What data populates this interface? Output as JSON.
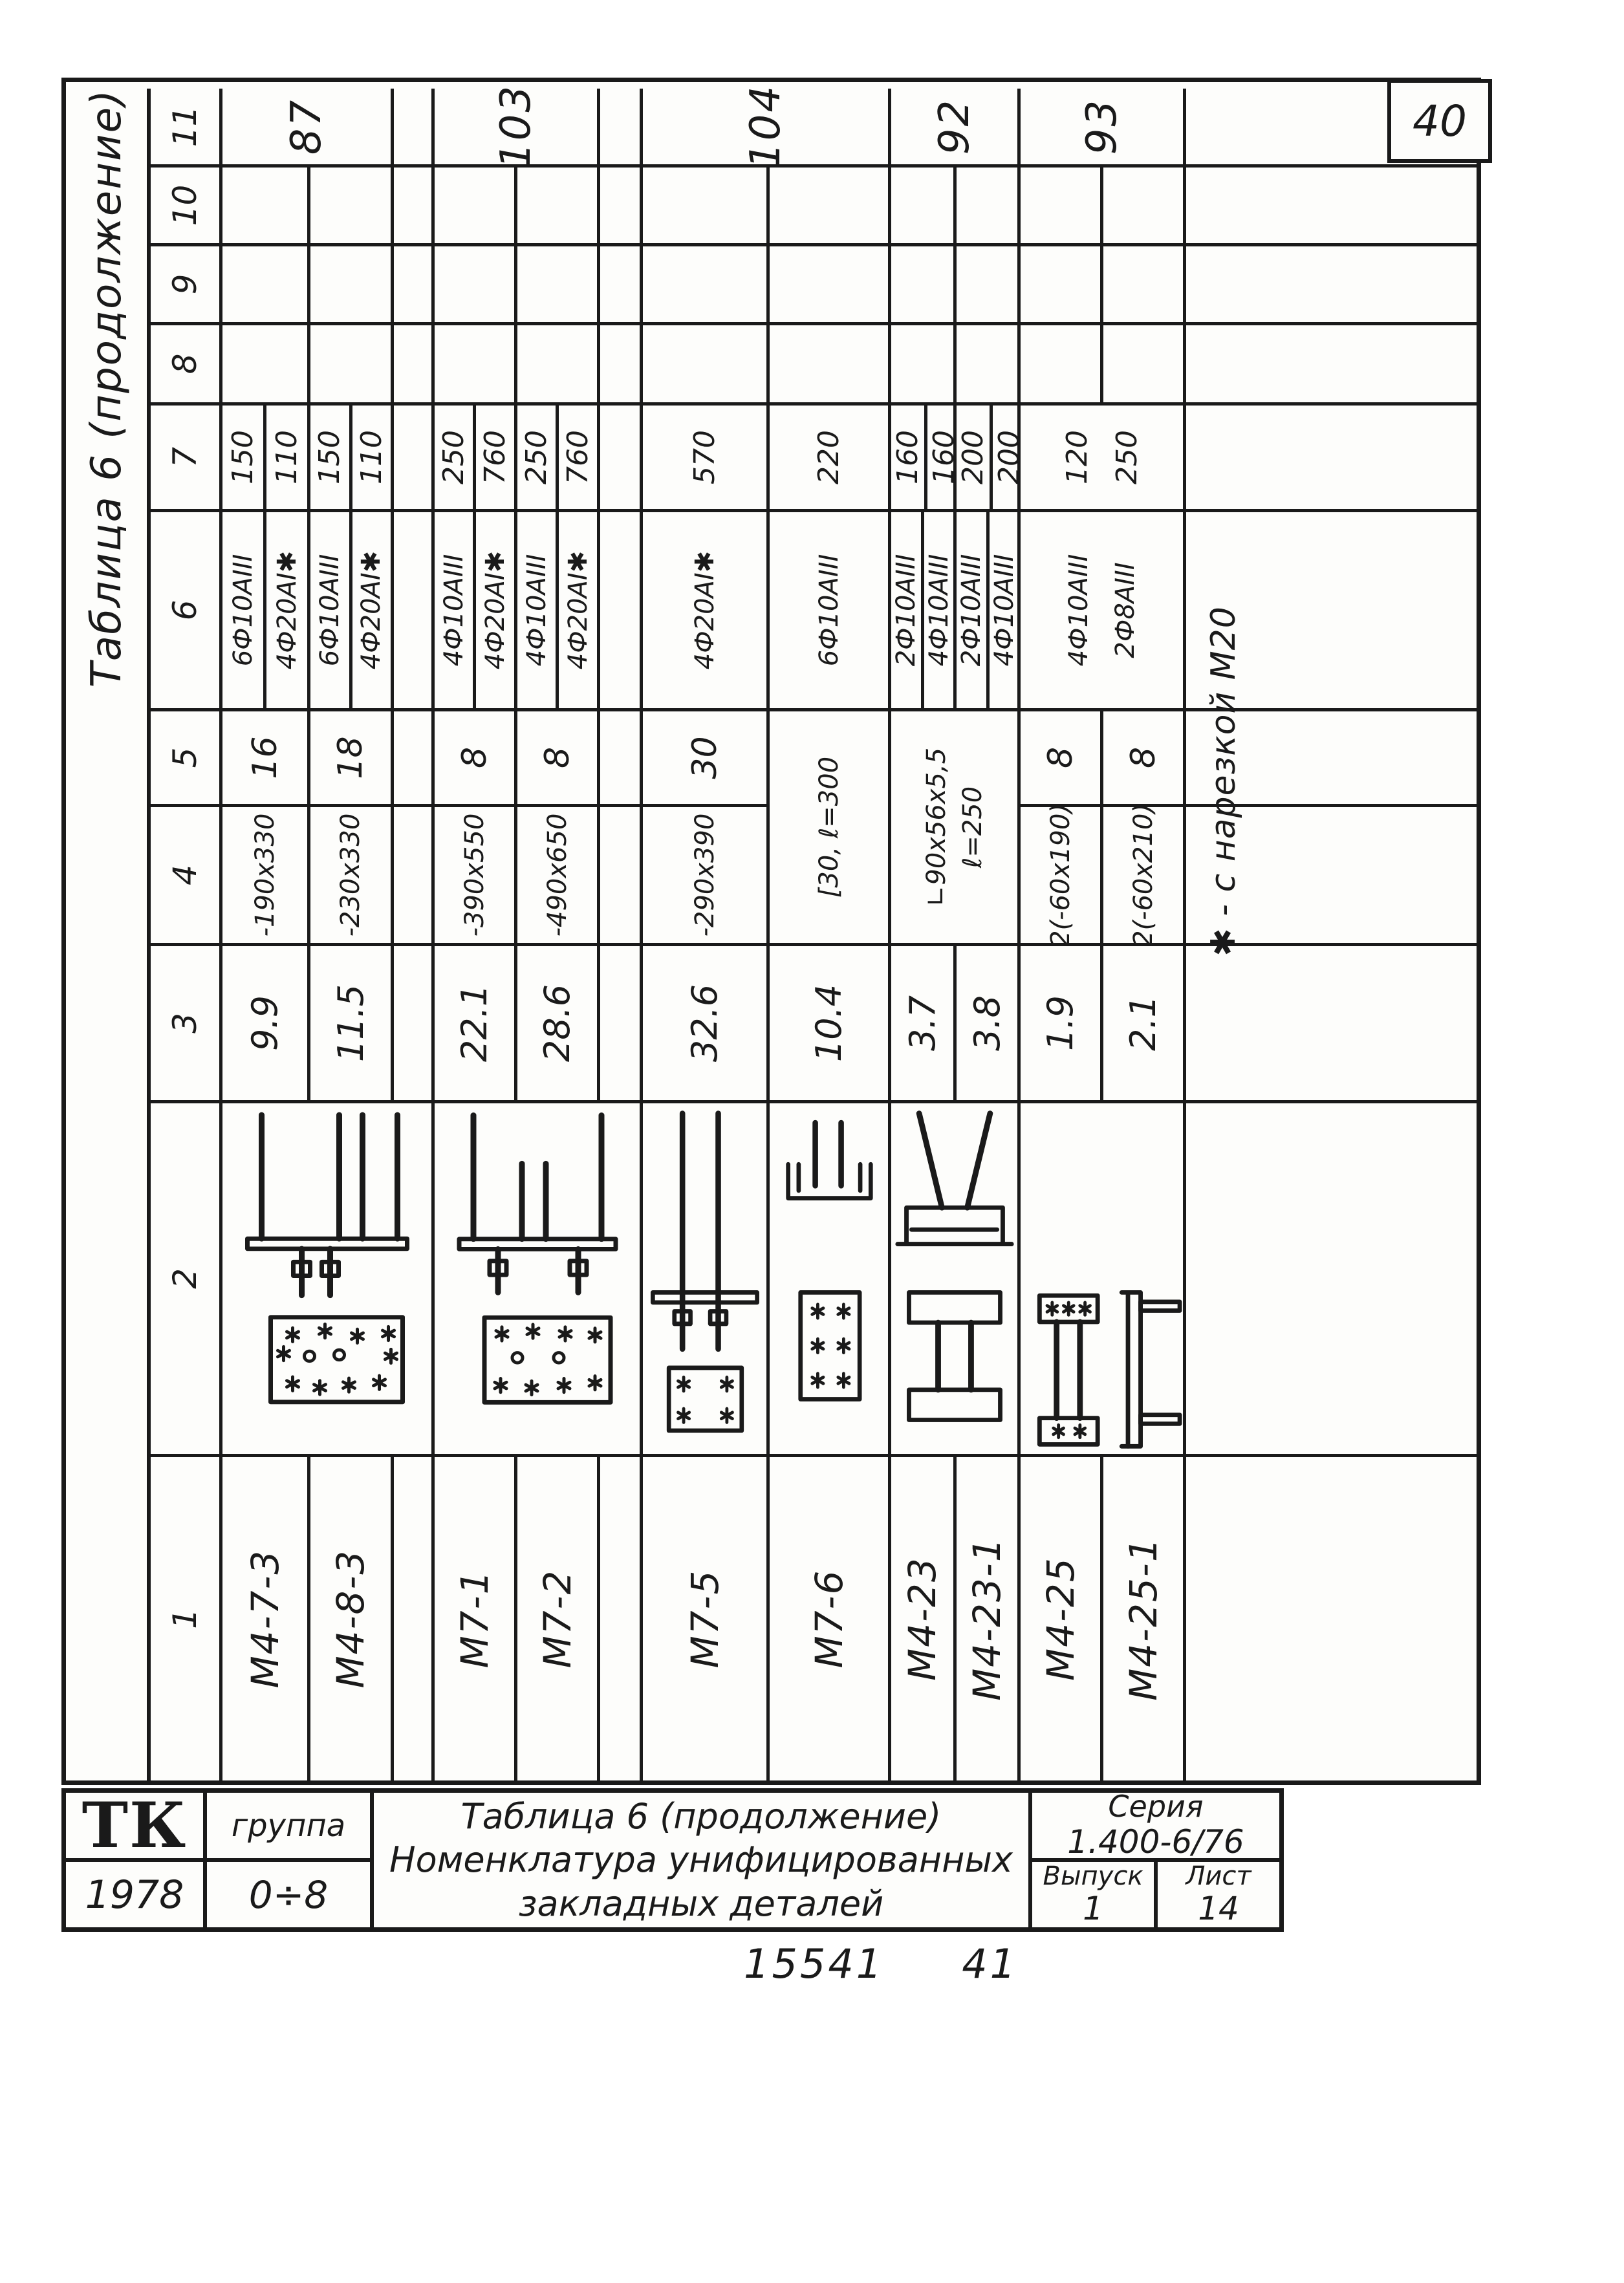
{
  "page": {
    "sheet_number": "40",
    "stamp_left": "15541",
    "stamp_right": "41"
  },
  "table": {
    "caption": "Таблица 6 (продолжение)",
    "headers": [
      "1",
      "2",
      "3",
      "4",
      "5",
      "6",
      "7",
      "8",
      "9",
      "10",
      "11"
    ],
    "rows": [
      {
        "mark": "М4-7-3",
        "mass": "9.9",
        "plate": "-190x330",
        "qty": "16",
        "rebar1": "6Ф10АIII",
        "len1": "150",
        "rebar2": "4Ф20АI✱",
        "len2": "110"
      },
      {
        "mark": "М4-8-3",
        "mass": "11.5",
        "plate": "-230x330",
        "qty": "18",
        "rebar1": "6Ф10АIII",
        "len1": "150",
        "rebar2": "4Ф20АI✱",
        "len2": "110"
      },
      {
        "mark": "М7-1",
        "mass": "22.1",
        "plate": "-390x550",
        "qty": "8",
        "rebar1": "4Ф10АIII",
        "len1": "250",
        "rebar2": "4Ф20АI✱",
        "len2": "760"
      },
      {
        "mark": "М7-2",
        "mass": "28.6",
        "plate": "-490x650",
        "qty": "8",
        "rebar1": "4Ф10АIII",
        "len1": "250",
        "rebar2": "4Ф20АI✱",
        "len2": "760"
      },
      {
        "mark": "М7-5",
        "mass": "32.6",
        "plate": "-290x390",
        "qty": "30",
        "rebar1": "4Ф20АI✱",
        "len1": "570"
      },
      {
        "mark": "М7-6",
        "mass": "10.4",
        "plate": "[30, ℓ=300",
        "rebar1": "6Ф10АIII",
        "len1": "220"
      },
      {
        "mark": "М4-23",
        "mass": "3.7",
        "rebar1": "2Ф10АIII",
        "len1": "160",
        "rebar2": "4Ф10АIII",
        "len2": "160"
      },
      {
        "mark": "М4-23-1",
        "mass": "3.8",
        "rebar1": "2Ф10АIII",
        "len1": "200",
        "rebar2": "4Ф10АIII",
        "len2": "200"
      },
      {
        "mark": "М4-25",
        "mass": "1.9",
        "plate": "2(-60x190)",
        "qty": "8",
        "rebar1": "4Ф10АIII",
        "len1": "120"
      },
      {
        "mark": "М4-25-1",
        "mass": "2.1",
        "plate": "2(-60x210)",
        "qty": "8",
        "rebar1": "2Ф8АIII",
        "len1": "250"
      }
    ],
    "angle_spec_line1": "∟90x56x5,5",
    "angle_spec_line2": "ℓ=250",
    "group_masses": [
      "87",
      "103",
      "104",
      "92",
      "93"
    ],
    "footnote": "✱ - с нарезкой М20"
  },
  "title_block": {
    "logo": "ТК",
    "year": "1978",
    "group_label": "группа",
    "group_value": "0÷8",
    "title_line1": "Таблица 6 (продолжение)",
    "title_line2": "Номенклатура унифицированных",
    "title_line3": "закладных деталей",
    "series_label": "Серия",
    "series_value": "1.400-6/76",
    "issue_label": "Выпуск",
    "issue_value": "1",
    "sheet_label": "Лист",
    "sheet_value": "14"
  }
}
